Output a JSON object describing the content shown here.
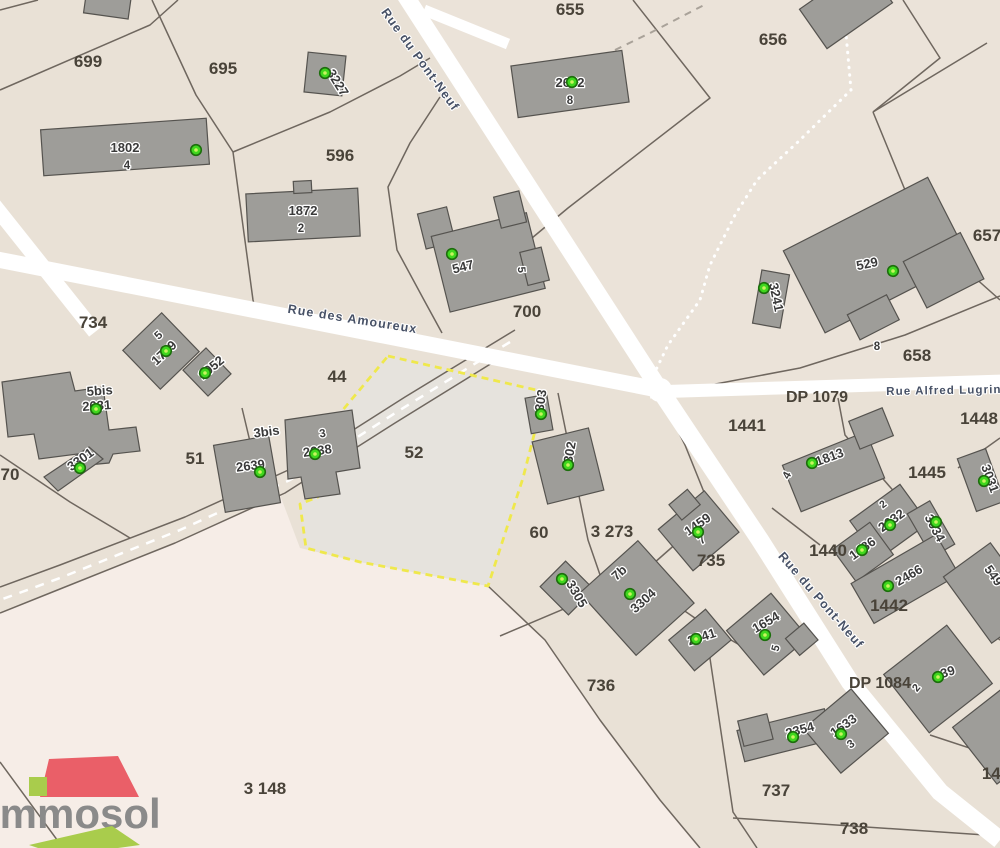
{
  "app": {
    "title": "Immosol cadastral map",
    "highlighted_parcel": "52"
  },
  "logo": {
    "name": "Immosol"
  },
  "colors": {
    "base": "#e9e1d6",
    "ne_region": "#ebe3d9",
    "pink_region": "#f6ede7",
    "parcel52": "#e6e3dd",
    "road": "#ffffff",
    "boundary": "#6f675f",
    "building_fill": "#9e9d99",
    "building_stroke": "#55534f",
    "marker_green": "#3fd71e",
    "marker_center": "#c8f45e",
    "marker_stroke": "#1c6e0c",
    "highlight_yellow": "#efe84c",
    "parcel_label": "#494339",
    "building_label": "#3a3a3a",
    "road_label": "#475166",
    "logo_red": "#ea5f68",
    "logo_green": "#a9cc4c",
    "logo_gray": "#8a8a8a"
  },
  "parcel_labels": [
    {
      "text": "699",
      "x": 88,
      "y": 67
    },
    {
      "text": "695",
      "x": 223,
      "y": 74
    },
    {
      "text": "655",
      "x": 570,
      "y": 15
    },
    {
      "text": "656",
      "x": 773,
      "y": 45
    },
    {
      "text": "596",
      "x": 340,
      "y": 161
    },
    {
      "text": "657",
      "x": 987,
      "y": 241
    },
    {
      "text": "700",
      "x": 527,
      "y": 317
    },
    {
      "text": "734",
      "x": 93,
      "y": 328
    },
    {
      "text": "658",
      "x": 917,
      "y": 361
    },
    {
      "text": "44",
      "x": 337,
      "y": 382
    },
    {
      "text": "52",
      "x": 414,
      "y": 458
    },
    {
      "text": "51",
      "x": 195,
      "y": 464
    },
    {
      "text": "70",
      "x": 10,
      "y": 480
    },
    {
      "text": "60",
      "x": 539,
      "y": 538
    },
    {
      "text": "3 273",
      "x": 612,
      "y": 537
    },
    {
      "text": "735",
      "x": 711,
      "y": 566
    },
    {
      "text": "1441",
      "x": 747,
      "y": 431
    },
    {
      "text": "1448",
      "x": 979,
      "y": 424
    },
    {
      "text": "1445",
      "x": 927,
      "y": 478
    },
    {
      "text": "1440",
      "x": 828,
      "y": 556
    },
    {
      "text": "1442",
      "x": 889,
      "y": 611
    },
    {
      "text": "736",
      "x": 601,
      "y": 691
    },
    {
      "text": "737",
      "x": 776,
      "y": 796
    },
    {
      "text": "738",
      "x": 854,
      "y": 834
    },
    {
      "text": "3 148",
      "x": 265,
      "y": 794
    },
    {
      "text": "144",
      "x": 996,
      "y": 779
    }
  ],
  "route_labels": [
    {
      "text": "DP 1079",
      "x": 817,
      "y": 402
    },
    {
      "text": "DP 1084",
      "x": 880,
      "y": 688
    }
  ],
  "road_labels": [
    {
      "text": "Rue du Pont-Neuf",
      "x": 417,
      "y": 62,
      "rot": 54
    },
    {
      "text": "Rue des Amoureux",
      "x": 352,
      "y": 323,
      "rot": 9
    },
    {
      "text": "Rue Alfred Lugrin",
      "x": 944,
      "y": 394,
      "rot": -1,
      "size": 11.5
    },
    {
      "text": "Rue du Pont-Neuf",
      "x": 818,
      "y": 603,
      "rot": 49
    }
  ],
  "building_labels": [
    {
      "text": "3227",
      "x": 334,
      "y": 85,
      "rot": 58
    },
    {
      "text": "1802",
      "x": 125,
      "y": 152
    },
    {
      "text": "4",
      "x": 127,
      "y": 169,
      "size": 11.5
    },
    {
      "text": "2642",
      "x": 570,
      "y": 87
    },
    {
      "text": "8",
      "x": 570,
      "y": 104,
      "size": 11.5
    },
    {
      "text": "1872",
      "x": 303,
      "y": 215
    },
    {
      "text": "2",
      "x": 301,
      "y": 232,
      "size": 11.5
    },
    {
      "text": "547",
      "x": 464,
      "y": 271,
      "rot": -14
    },
    {
      "text": "5",
      "x": 518,
      "y": 270,
      "rot": 85,
      "size": 11
    },
    {
      "text": "529",
      "x": 868,
      "y": 268,
      "rot": -12
    },
    {
      "text": "8",
      "x": 877,
      "y": 350,
      "size": 11.5
    },
    {
      "text": "3241",
      "x": 772,
      "y": 298,
      "rot": 78
    },
    {
      "text": "5",
      "x": 161,
      "y": 338,
      "rot": -43,
      "size": 11.5
    },
    {
      "text": "1709",
      "x": 167,
      "y": 356,
      "rot": -43
    },
    {
      "text": "1952",
      "x": 214,
      "y": 371,
      "rot": -40
    },
    {
      "text": "5bis",
      "x": 100,
      "y": 395,
      "rot": -4
    },
    {
      "text": "2631",
      "x": 97,
      "y": 410,
      "rot": -4
    },
    {
      "text": "3301",
      "x": 83,
      "y": 463,
      "rot": -36
    },
    {
      "text": "3bis",
      "x": 267,
      "y": 436,
      "rot": -7
    },
    {
      "text": "2639",
      "x": 251,
      "y": 470,
      "rot": -7
    },
    {
      "text": "3",
      "x": 323,
      "y": 437,
      "rot": -8,
      "size": 11.5
    },
    {
      "text": "2638",
      "x": 318,
      "y": 455,
      "rot": -8
    },
    {
      "text": "303",
      "x": 545,
      "y": 401,
      "rot": -82
    },
    {
      "text": "302",
      "x": 574,
      "y": 453,
      "rot": -80
    },
    {
      "text": "1813",
      "x": 831,
      "y": 461,
      "rot": -20
    },
    {
      "text": "4",
      "x": 790,
      "y": 477,
      "rot": -62,
      "size": 11.5
    },
    {
      "text": "3031",
      "x": 986,
      "y": 480,
      "rot": 70
    },
    {
      "text": "2",
      "x": 885,
      "y": 507,
      "rot": -38,
      "size": 10.5
    },
    {
      "text": "2632",
      "x": 894,
      "y": 524,
      "rot": -36
    },
    {
      "text": "3034",
      "x": 931,
      "y": 530,
      "rot": 62
    },
    {
      "text": "1486",
      "x": 865,
      "y": 552,
      "rot": -36
    },
    {
      "text": "2466",
      "x": 911,
      "y": 579,
      "rot": -30
    },
    {
      "text": "549",
      "x": 990,
      "y": 578,
      "rot": 55
    },
    {
      "text": "3305",
      "x": 573,
      "y": 596,
      "rot": 60
    },
    {
      "text": "7b",
      "x": 622,
      "y": 576,
      "rot": -42
    },
    {
      "text": "3304",
      "x": 646,
      "y": 604,
      "rot": -42
    },
    {
      "text": "1459",
      "x": 700,
      "y": 528,
      "rot": -35
    },
    {
      "text": "7",
      "x": 704,
      "y": 543,
      "rot": -35,
      "size": 11.5
    },
    {
      "text": "2641",
      "x": 703,
      "y": 641,
      "rot": -18
    },
    {
      "text": "1654",
      "x": 768,
      "y": 626,
      "rot": -30
    },
    {
      "text": "5",
      "x": 779,
      "y": 649,
      "rot": -75,
      "size": 11
    },
    {
      "text": "2354",
      "x": 801,
      "y": 734,
      "rot": -15
    },
    {
      "text": "1633",
      "x": 846,
      "y": 729,
      "rot": -36
    },
    {
      "text": "3",
      "x": 853,
      "y": 747,
      "rot": -36,
      "size": 11.5
    },
    {
      "text": "39",
      "x": 949,
      "y": 676,
      "rot": -18
    },
    {
      "text": "2",
      "x": 919,
      "y": 690,
      "rot": -50,
      "size": 11
    }
  ],
  "markers": [
    {
      "x": 325,
      "y": 73
    },
    {
      "x": 196,
      "y": 150
    },
    {
      "x": 572,
      "y": 82
    },
    {
      "x": 893,
      "y": 271
    },
    {
      "x": 452,
      "y": 254
    },
    {
      "x": 764,
      "y": 288
    },
    {
      "x": 166,
      "y": 351
    },
    {
      "x": 205,
      "y": 373
    },
    {
      "x": 96,
      "y": 409
    },
    {
      "x": 80,
      "y": 468
    },
    {
      "x": 260,
      "y": 472
    },
    {
      "x": 315,
      "y": 454
    },
    {
      "x": 541,
      "y": 414
    },
    {
      "x": 568,
      "y": 465
    },
    {
      "x": 812,
      "y": 463
    },
    {
      "x": 984,
      "y": 481
    },
    {
      "x": 890,
      "y": 525
    },
    {
      "x": 862,
      "y": 550
    },
    {
      "x": 936,
      "y": 522
    },
    {
      "x": 888,
      "y": 586
    },
    {
      "x": 562,
      "y": 579
    },
    {
      "x": 630,
      "y": 594
    },
    {
      "x": 698,
      "y": 532
    },
    {
      "x": 696,
      "y": 639
    },
    {
      "x": 765,
      "y": 635
    },
    {
      "x": 793,
      "y": 737
    },
    {
      "x": 841,
      "y": 734
    },
    {
      "x": 938,
      "y": 677
    }
  ]
}
